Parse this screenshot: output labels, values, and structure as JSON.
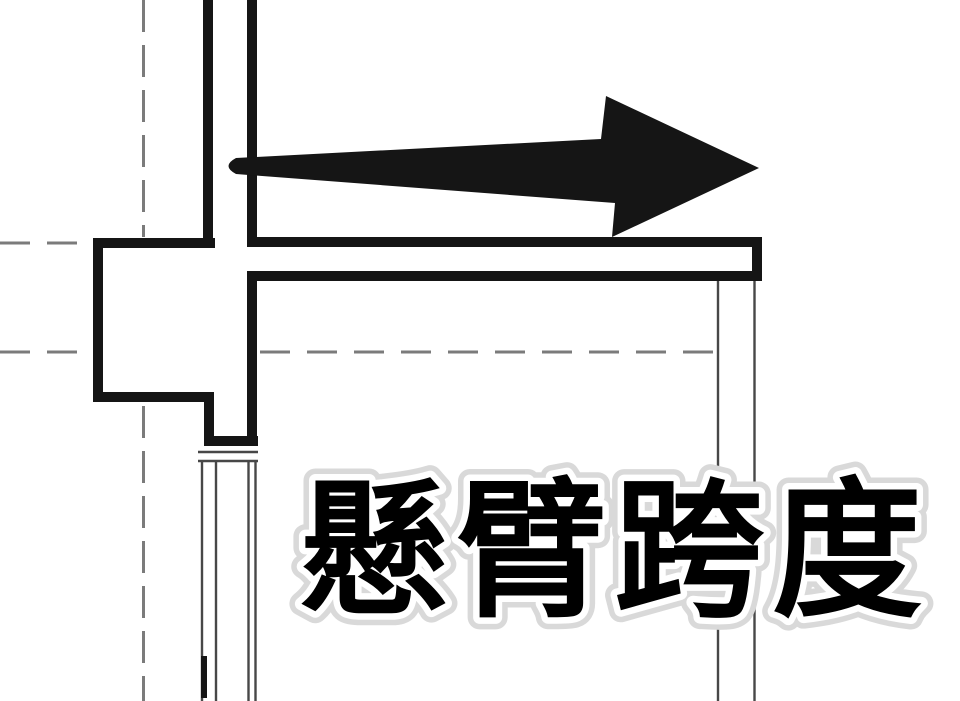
{
  "canvas": {
    "width": 960,
    "height": 701,
    "background": "#ffffff"
  },
  "colors": {
    "line": "#151515",
    "thin_line": "#474747",
    "dash": "#7b7b7b",
    "text_fill": "#000000",
    "text_halo": "#ffffff",
    "text_glow": "#d9d9d9"
  },
  "annotation": {
    "label": "懸臂跨度"
  },
  "drawing": {
    "arrow": {
      "name": "cantilever-span-arrow",
      "direction": "right"
    }
  }
}
